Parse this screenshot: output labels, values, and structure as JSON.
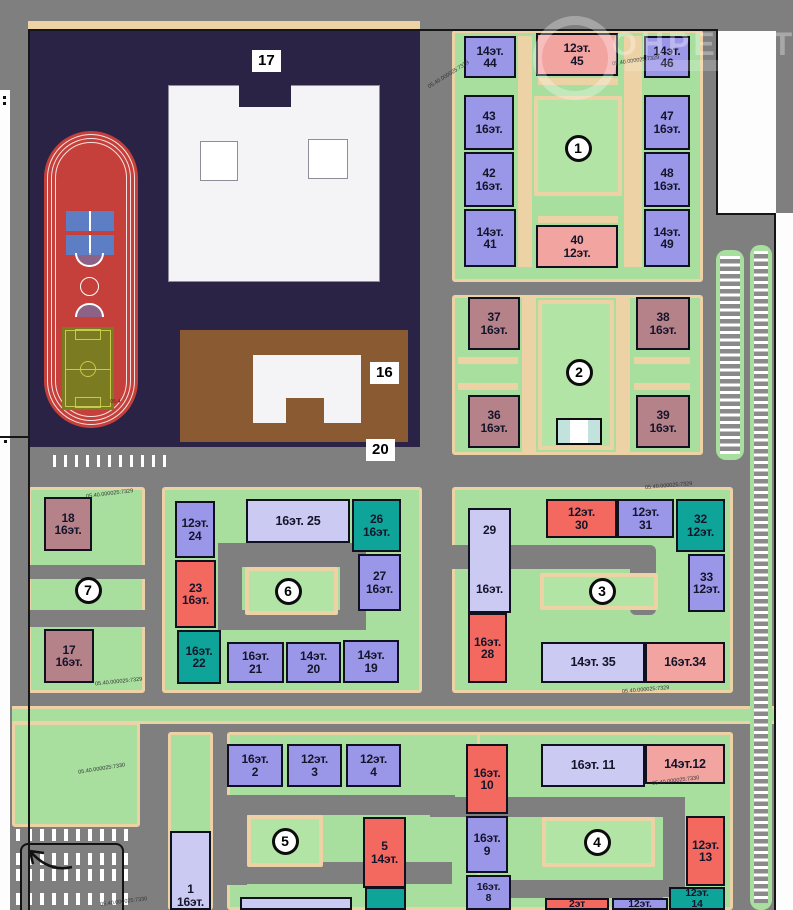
{
  "watermark": {
    "text": "ОНРЕАЛТ"
  },
  "boxes": {
    "school": "17",
    "kindergarten": "16",
    "road": "20"
  },
  "cadastral": {
    "a": "05.40.000025:7329",
    "b": "05.40.000025:7330"
  },
  "stadium_code": "05.4",
  "palette": {
    "purple": "#9b97e8",
    "lavender": "#cbcaf2",
    "red": "#f4695f",
    "pink": "#f2a4a1",
    "teal": "#0fa49a",
    "mauve": "#b5828a",
    "green_yard": "#a8df9f",
    "road_gray": "#7f7f7f",
    "path_beige": "#ecd2a4",
    "school_block_navy": "#2b2345",
    "kindergarten_brown": "#8a5a33",
    "track_red": "#c5403a",
    "field_olive": "#7b7b21"
  },
  "circles": [
    {
      "n": "1",
      "x": 578,
      "y": 148
    },
    {
      "n": "2",
      "x": 579,
      "y": 372
    },
    {
      "n": "3",
      "x": 602,
      "y": 591
    },
    {
      "n": "4",
      "x": 597,
      "y": 842
    },
    {
      "n": "5",
      "x": 285,
      "y": 841
    },
    {
      "n": "6",
      "x": 288,
      "y": 591
    },
    {
      "n": "7",
      "x": 88,
      "y": 590
    }
  ],
  "buildings": [
    {
      "id": "44",
      "lines": [
        "14эт.",
        "44"
      ],
      "c": "purple",
      "x": 464,
      "y": 36,
      "w": 52,
      "h": 42
    },
    {
      "id": "43",
      "lines": [
        "43",
        "16эт."
      ],
      "c": "purple",
      "x": 464,
      "y": 95,
      "w": 50,
      "h": 55
    },
    {
      "id": "42",
      "lines": [
        "42",
        "16эт."
      ],
      "c": "purple",
      "x": 464,
      "y": 152,
      "w": 50,
      "h": 55
    },
    {
      "id": "41",
      "lines": [
        "14эт.",
        "41"
      ],
      "c": "purple",
      "x": 464,
      "y": 209,
      "w": 52,
      "h": 58
    },
    {
      "id": "45",
      "lines": [
        "12эт.",
        "45"
      ],
      "c": "pink",
      "x": 536,
      "y": 33,
      "w": 82,
      "h": 43
    },
    {
      "id": "40",
      "lines": [
        "40",
        "12эт."
      ],
      "c": "pink",
      "x": 536,
      "y": 225,
      "w": 82,
      "h": 43
    },
    {
      "id": "46",
      "lines": [
        "14эт.",
        "46"
      ],
      "c": "purple",
      "x": 644,
      "y": 36,
      "w": 46,
      "h": 42
    },
    {
      "id": "47",
      "lines": [
        "47",
        "16эт."
      ],
      "c": "purple",
      "x": 644,
      "y": 95,
      "w": 46,
      "h": 55
    },
    {
      "id": "48",
      "lines": [
        "48",
        "16эт."
      ],
      "c": "purple",
      "x": 644,
      "y": 152,
      "w": 46,
      "h": 55
    },
    {
      "id": "49",
      "lines": [
        "14эт.",
        "49"
      ],
      "c": "purple",
      "x": 644,
      "y": 209,
      "w": 46,
      "h": 58
    },
    {
      "id": "37",
      "lines": [
        "37",
        "16эт."
      ],
      "c": "mauve",
      "x": 468,
      "y": 297,
      "w": 52,
      "h": 53
    },
    {
      "id": "38",
      "lines": [
        "38",
        "16эт."
      ],
      "c": "mauve",
      "x": 636,
      "y": 297,
      "w": 54,
      "h": 53
    },
    {
      "id": "36",
      "lines": [
        "36",
        "16эт."
      ],
      "c": "mauve",
      "x": 468,
      "y": 395,
      "w": 52,
      "h": 53
    },
    {
      "id": "39",
      "lines": [
        "39",
        "16эт."
      ],
      "c": "mauve",
      "x": 636,
      "y": 395,
      "w": 54,
      "h": 53
    },
    {
      "id": "18",
      "lines": [
        "18",
        "16эт."
      ],
      "c": "mauve",
      "x": 44,
      "y": 497,
      "w": 48,
      "h": 54
    },
    {
      "id": "17",
      "lines": [
        "17",
        "16эт."
      ],
      "c": "mauve",
      "x": 44,
      "y": 629,
      "w": 50,
      "h": 54
    },
    {
      "id": "24",
      "lines": [
        "12эт.",
        "24"
      ],
      "c": "purple",
      "x": 175,
      "y": 501,
      "w": 40,
      "h": 57
    },
    {
      "id": "23",
      "lines": [
        "23",
        "16эт."
      ],
      "c": "red",
      "x": 175,
      "y": 560,
      "w": 41,
      "h": 68
    },
    {
      "id": "22",
      "lines": [
        "16эт.",
        "22"
      ],
      "c": "teal",
      "x": 177,
      "y": 630,
      "w": 44,
      "h": 54
    },
    {
      "id": "25",
      "lines": [
        "16эт.  25"
      ],
      "c": "lavender",
      "x": 246,
      "y": 499,
      "w": 104,
      "h": 44,
      "cls": "wide"
    },
    {
      "id": "26",
      "lines": [
        "26",
        "16эт."
      ],
      "c": "teal",
      "x": 352,
      "y": 499,
      "w": 49,
      "h": 53
    },
    {
      "id": "27",
      "lines": [
        "27",
        "16эт."
      ],
      "c": "purple",
      "x": 358,
      "y": 554,
      "w": 43,
      "h": 57
    },
    {
      "id": "21",
      "lines": [
        "16эт.",
        "21"
      ],
      "c": "purple",
      "x": 227,
      "y": 642,
      "w": 57,
      "h": 41
    },
    {
      "id": "20",
      "lines": [
        "14эт.",
        "20"
      ],
      "c": "purple",
      "x": 286,
      "y": 642,
      "w": 55,
      "h": 41
    },
    {
      "id": "19",
      "lines": [
        "14эт.",
        "19"
      ],
      "c": "purple",
      "x": 343,
      "y": 640,
      "w": 56,
      "h": 43
    },
    {
      "id": "29",
      "lines": [
        "29",
        "16эт."
      ],
      "c": "lavender",
      "x": 468,
      "y": 508,
      "w": 43,
      "h": 105,
      "cls": "spread"
    },
    {
      "id": "28",
      "lines": [
        "16эт.",
        "28"
      ],
      "c": "red",
      "x": 468,
      "y": 613,
      "w": 39,
      "h": 70
    },
    {
      "id": "30",
      "lines": [
        "12эт.",
        "30"
      ],
      "c": "red",
      "x": 546,
      "y": 499,
      "w": 71,
      "h": 39
    },
    {
      "id": "31",
      "lines": [
        "12эт.",
        "31"
      ],
      "c": "purple",
      "x": 617,
      "y": 499,
      "w": 57,
      "h": 39
    },
    {
      "id": "32",
      "lines": [
        "32",
        "12эт."
      ],
      "c": "teal",
      "x": 676,
      "y": 499,
      "w": 49,
      "h": 53
    },
    {
      "id": "33",
      "lines": [
        "33",
        "12эт."
      ],
      "c": "purple",
      "x": 688,
      "y": 554,
      "w": 37,
      "h": 58
    },
    {
      "id": "35",
      "lines": [
        "14эт.  35"
      ],
      "c": "lavender",
      "x": 541,
      "y": 642,
      "w": 104,
      "h": 41,
      "cls": "wide"
    },
    {
      "id": "34",
      "lines": [
        "16эт.34"
      ],
      "c": "pink",
      "x": 645,
      "y": 642,
      "w": 80,
      "h": 41,
      "cls": "wide"
    },
    {
      "id": "2",
      "lines": [
        "16эт.",
        "2"
      ],
      "c": "purple",
      "x": 227,
      "y": 744,
      "w": 56,
      "h": 43
    },
    {
      "id": "3",
      "lines": [
        "12эт.",
        "3"
      ],
      "c": "purple",
      "x": 287,
      "y": 744,
      "w": 55,
      "h": 43
    },
    {
      "id": "4",
      "lines": [
        "12эт.",
        "4"
      ],
      "c": "purple",
      "x": 346,
      "y": 744,
      "w": 55,
      "h": 43
    },
    {
      "id": "1",
      "lines": [
        "1",
        "16эт."
      ],
      "c": "lavender",
      "x": 170,
      "y": 831,
      "w": 41,
      "h": 79,
      "cls": "bottom"
    },
    {
      "id": "5",
      "lines": [
        "5",
        "14эт."
      ],
      "c": "red",
      "x": 363,
      "y": 817,
      "w": 43,
      "h": 71
    },
    {
      "id": "6",
      "lines": [
        ""
      ],
      "c": "teal",
      "x": 365,
      "y": 887,
      "w": 41,
      "h": 23,
      "cls": "clip"
    },
    {
      "id": "10",
      "lines": [
        "16эт.",
        "10"
      ],
      "c": "red",
      "x": 466,
      "y": 744,
      "w": 42,
      "h": 70
    },
    {
      "id": "9",
      "lines": [
        "16эт.",
        "9"
      ],
      "c": "purple",
      "x": 466,
      "y": 816,
      "w": 42,
      "h": 57
    },
    {
      "id": "8",
      "lines": [
        "16эт.",
        "8"
      ],
      "c": "purple",
      "x": 466,
      "y": 875,
      "w": 45,
      "h": 35,
      "cls": "clip"
    },
    {
      "id": "11",
      "lines": [
        "16эт.  11"
      ],
      "c": "lavender",
      "x": 541,
      "y": 744,
      "w": 104,
      "h": 43,
      "cls": "wide"
    },
    {
      "id": "12",
      "lines": [
        "14эт.12"
      ],
      "c": "pink",
      "x": 645,
      "y": 744,
      "w": 80,
      "h": 40,
      "cls": "wide"
    },
    {
      "id": "13",
      "lines": [
        "12эт.",
        "13"
      ],
      "c": "red",
      "x": 686,
      "y": 816,
      "w": 39,
      "h": 70
    },
    {
      "id": "14",
      "lines": [
        "12эт.",
        "14"
      ],
      "c": "teal",
      "x": 669,
      "y": 887,
      "w": 56,
      "h": 23,
      "cls": "clip"
    },
    {
      "id": "2et",
      "lines": [
        "2эт"
      ],
      "c": "red",
      "x": 545,
      "y": 898,
      "w": 64,
      "h": 12,
      "cls": "clip"
    },
    {
      "id": "12et",
      "lines": [
        "12эт."
      ],
      "c": "purple",
      "x": 612,
      "y": 898,
      "w": 56,
      "h": 12,
      "cls": "clip"
    },
    {
      "id": "7b",
      "lines": [
        ""
      ],
      "c": "lavender",
      "x": 240,
      "y": 897,
      "w": 112,
      "h": 13,
      "cls": "clip"
    }
  ]
}
